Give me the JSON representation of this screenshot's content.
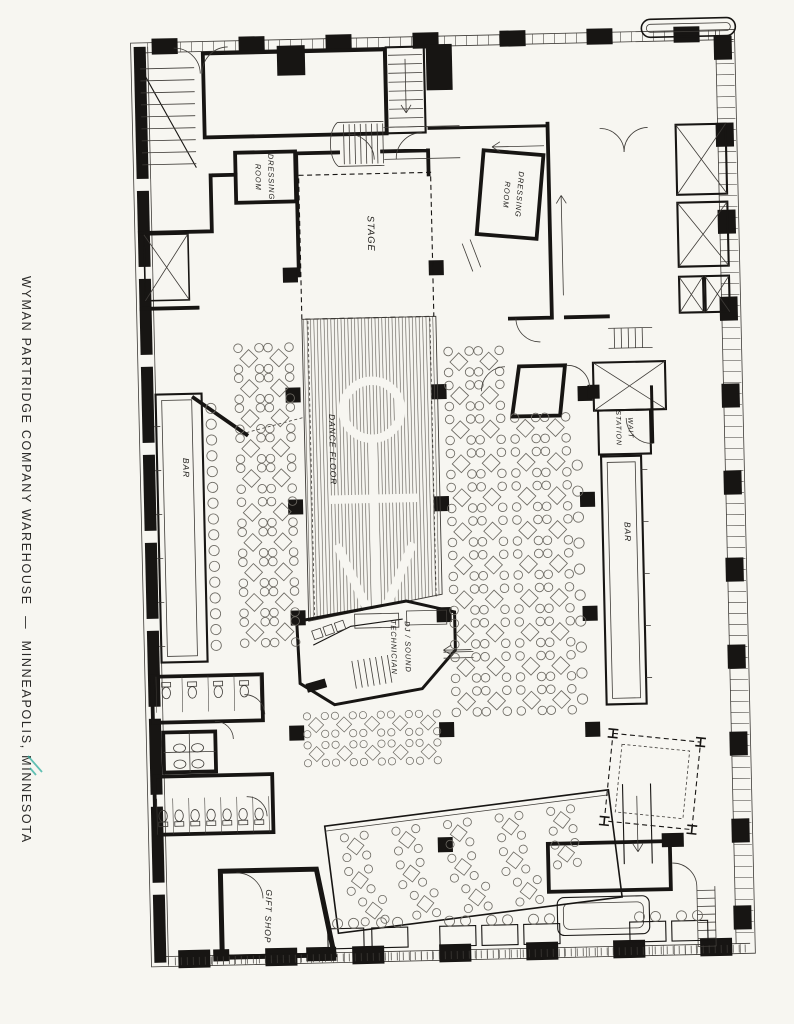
{
  "title": {
    "text": "WYMAN PARTRIDGE COMPANY WAREHOUSE  —  MINNEAPOLIS, MINNESOTA"
  },
  "rooms": {
    "stage": "STAGE",
    "dance_floor": "DANCE FLOOR",
    "dressing_room": {
      "line1": "DRESSING",
      "line2": "ROOM"
    },
    "bar_left": "BAR",
    "bar_right": "BAR",
    "wait_station": {
      "line1": "WAIT",
      "line2": "STATION"
    },
    "dj_booth": {
      "line1": "DJ / SOUND",
      "line2": "TECHNICIAN"
    },
    "gift_shop": "GIFT SHOP"
  },
  "colors": {
    "paper": "#f7f6f1",
    "ink": "#171513",
    "detail_line": "#3e3b37",
    "furniture": "#6d6a63",
    "floor_stripe": "#56524c",
    "scan_artifact": "#2fae9e"
  }
}
